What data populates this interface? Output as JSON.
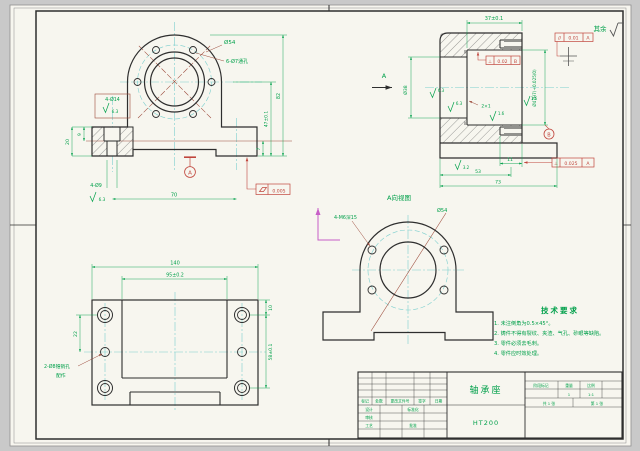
{
  "sheet": {
    "surface_note": "其余"
  },
  "colors": {
    "outline": "#2e2e2e",
    "dimension": "#00a04a",
    "annotation_red": "#c0453c",
    "centerline": "#7ccfce",
    "construction": "#9c4a3a",
    "rotation_arrow": "#c75fc7",
    "paper": "#f7f6ef",
    "background": "#c9c9c9"
  },
  "front_view": {
    "dia54": "Ø54",
    "flange_holes": "6-Ø7通孔",
    "cbore": "4-Ø14",
    "cbore_ra": "6.3",
    "depth20": "20",
    "depth9": "9",
    "drill": "4-Ø9",
    "drill_ra": "6.3",
    "width70": "70",
    "height82": "82",
    "height47": "47±0.1",
    "height7": "7",
    "datum": "A",
    "flatness": "0.005"
  },
  "side_view": {
    "depth37": "37±0.1",
    "view_arrow": "A",
    "dia38": "Ø38",
    "dia47": "Ø47H7(+0.025/0)",
    "groove": "2×1",
    "ra_bore1": "6.3",
    "ra_bore2": "6.3",
    "ra_groove": "1.6",
    "ra_face": "1.6",
    "ra_base": "3.2",
    "parallel_sym": "//",
    "parallel_val": "0.01",
    "parallel_ref": "A",
    "perp1_sym": "⊥",
    "perp1_val": "0.02",
    "perp1_ref": "B",
    "perp2_sym": "⊥",
    "perp2_val": "0.025",
    "perp2_ref": "A",
    "datum_b": "B",
    "len11": "11",
    "len53": "53",
    "len73": "73"
  },
  "aux_view": {
    "label": "A向视图",
    "holes": "4-M6深15",
    "dia54": "Ø54"
  },
  "bottom_view": {
    "width140": "140",
    "width95": "95±0.2",
    "pitch22": "22",
    "edge10": "10",
    "pitch58": "58±0.1",
    "pin_note1": "2-Ø8锥销孔",
    "pin_note2": "配作"
  },
  "tech_req": {
    "title": "技术要求",
    "lines": [
      "1. 未注倒角为0.5×45°。",
      "2. 铸件不得有裂纹、夹渣、气孔、砂眼等缺陷。",
      "3. 零件必须去毛刺。",
      "4. 零件应时效处理。"
    ]
  },
  "title_block": {
    "part_name": "轴承座",
    "material": "HT200",
    "col_mark": "标记",
    "col_count": "处数",
    "col_file": "更改文件号",
    "col_sign": "签字",
    "col_date": "日期",
    "row_design": "设计",
    "row_check": "审核",
    "row_process": "工艺",
    "row_standard": "标准化",
    "row_approve": "批准",
    "stage": "阶段标记",
    "weight": "重量",
    "scale": "比例",
    "weight_val": "1",
    "scale_val": "1:1",
    "sheets_total": "共 1 张",
    "sheet_no": "第 1 张"
  }
}
